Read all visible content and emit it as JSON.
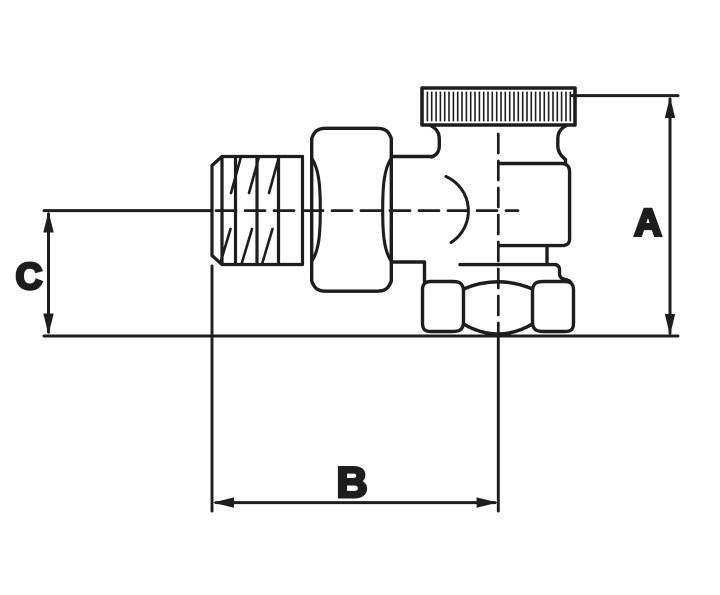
{
  "page": {
    "background": "#ffffff",
    "width": 720,
    "height": 595
  },
  "drawing": {
    "kind": "technical-dimension-drawing",
    "line_color": "#1d1d1d",
    "background_color": "#ffffff",
    "labels": {
      "a": "A",
      "b": "B",
      "c": "C"
    },
    "dimensions": [
      {
        "label": "A",
        "orientation": "vertical",
        "position": "right"
      },
      {
        "label": "B",
        "orientation": "horizontal",
        "position": "bottom"
      },
      {
        "label": "C",
        "orientation": "vertical",
        "position": "left"
      }
    ],
    "components": [
      "knurled-cap",
      "valve-body",
      "union-nut",
      "male-threaded-inlet",
      "bottom-outlet-hex-nut",
      "flow-direction-arc",
      "horizontal-axis-centerline",
      "vertical-axis-centerline"
    ]
  }
}
